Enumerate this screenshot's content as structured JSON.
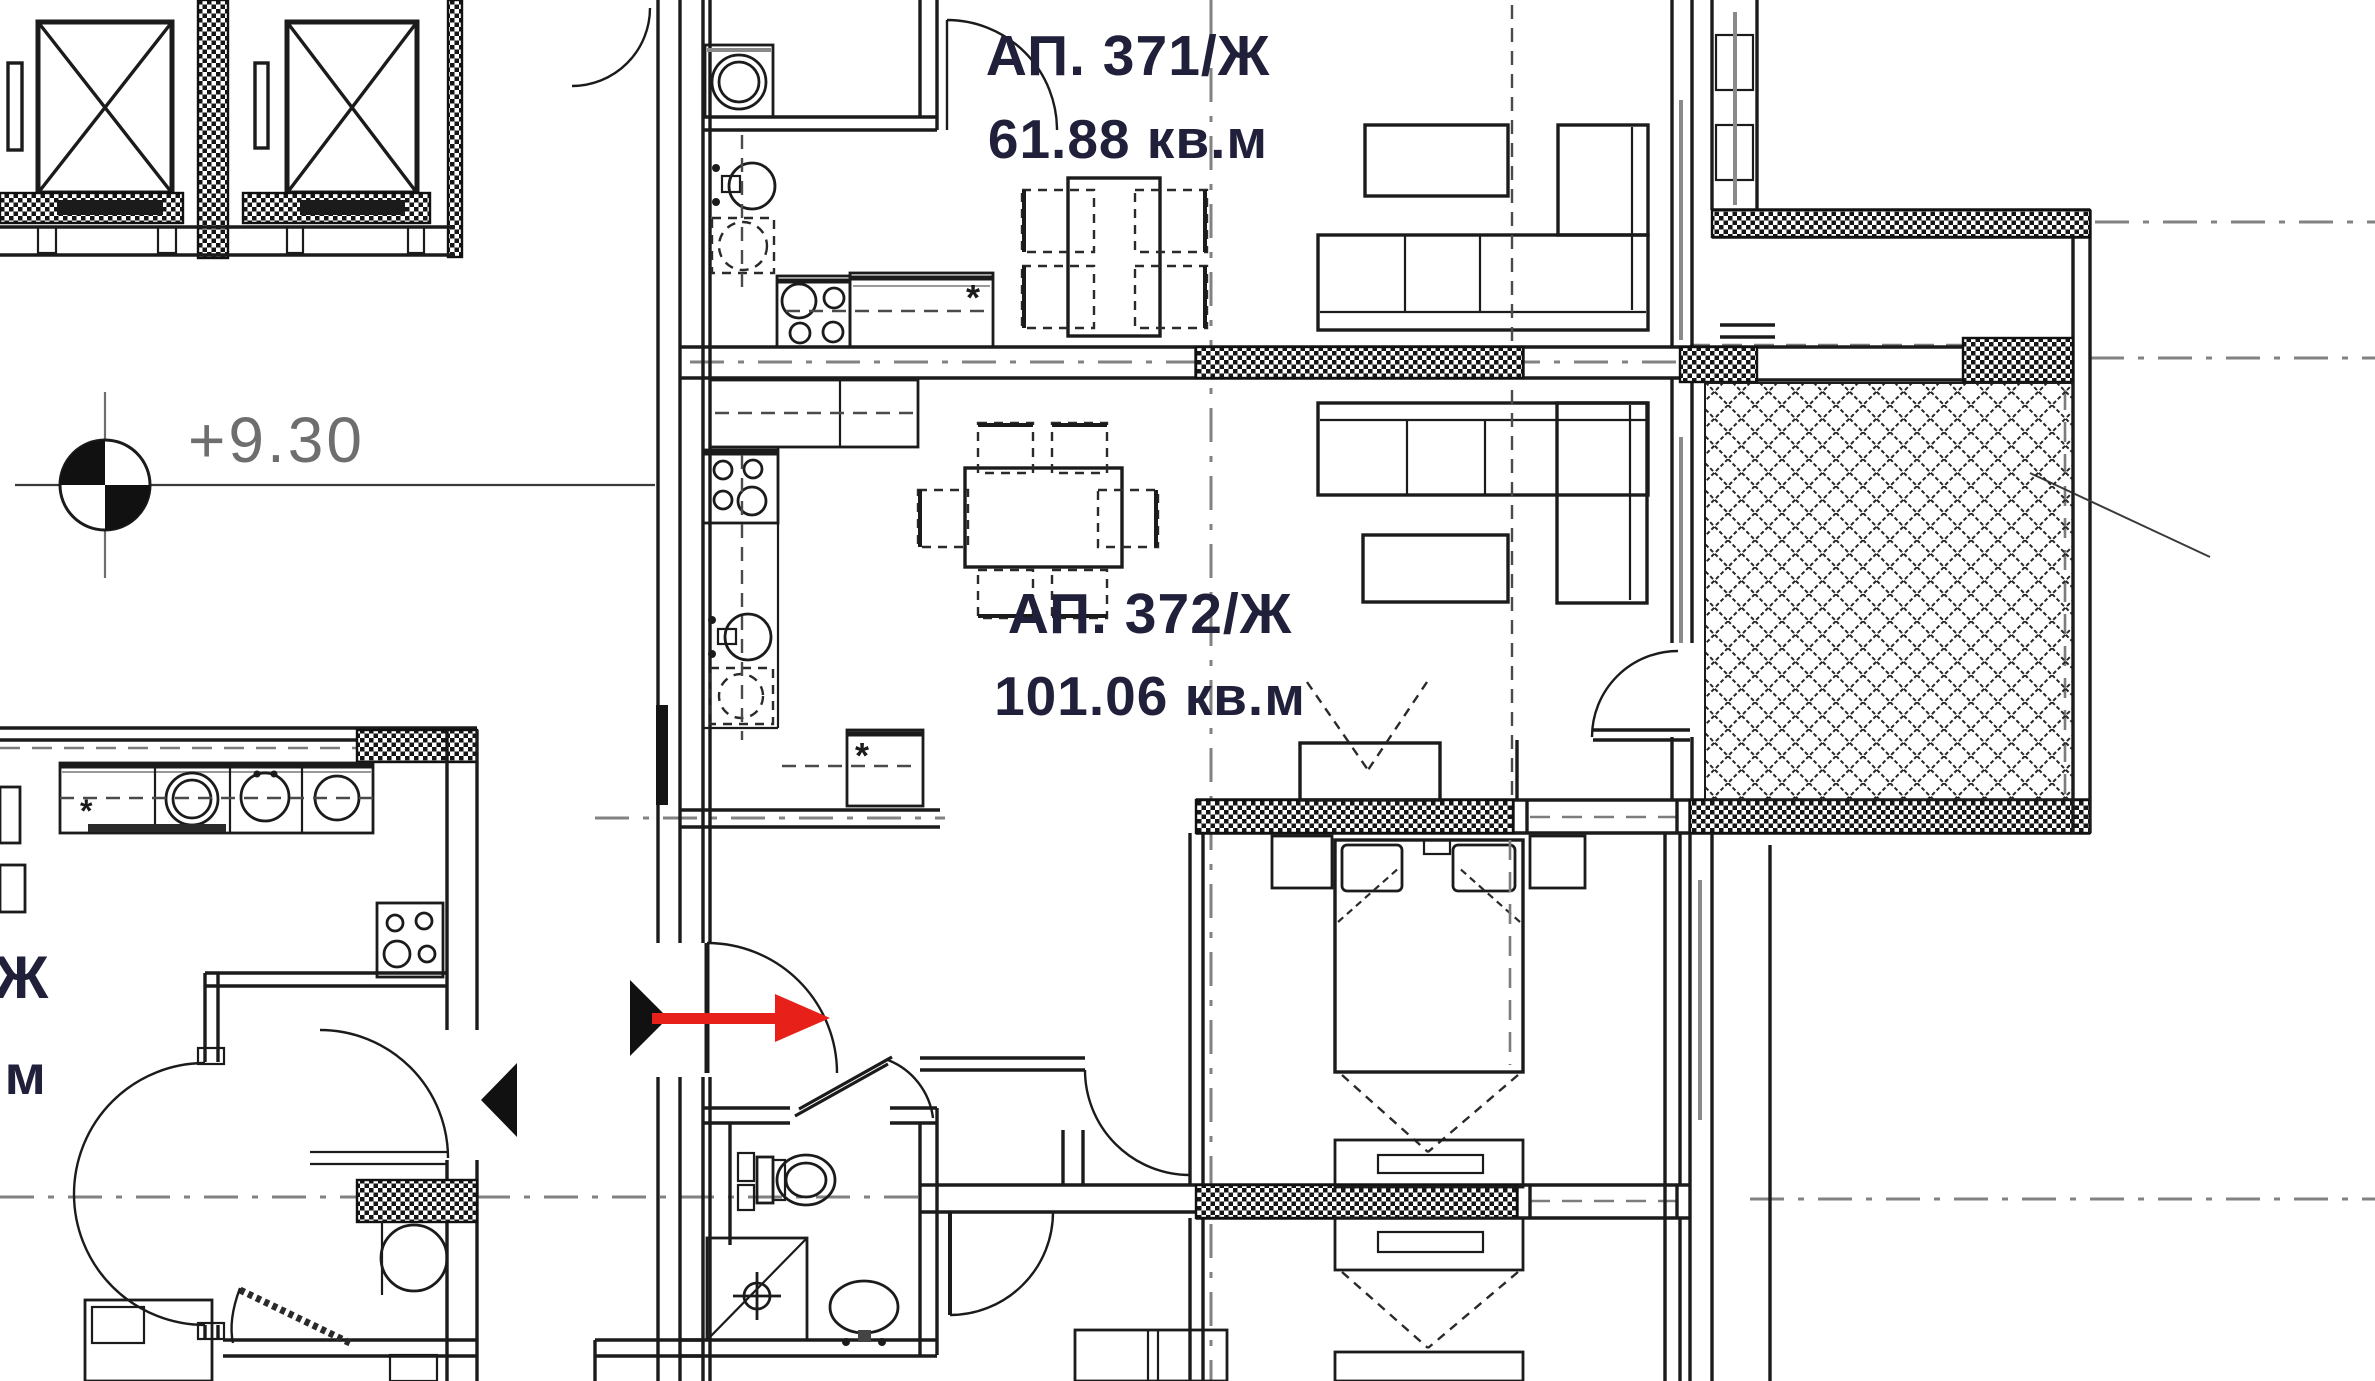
{
  "drawing": {
    "type": "architectural-floor-plan",
    "level_label": "+9.30",
    "apartments": [
      {
        "id": "371",
        "label": "АП. 371/Ж",
        "area": "61.88 кв.м"
      },
      {
        "id": "372",
        "label": "АП. 372/Ж",
        "area": "101.06 кв.м"
      },
      {
        "id": "left-cropped",
        "label_fragment": "Ж",
        "area_fragment": ".м"
      }
    ],
    "appliance_marker": "*",
    "colors": {
      "line": "#1b1b1b",
      "axis_gray": "#828282",
      "label_navy": "#20203a",
      "level_gray": "#6e6e6e",
      "entrance_red": "#e8201a",
      "window_gray": "#8a8a8a",
      "background": "#ffffff"
    }
  }
}
